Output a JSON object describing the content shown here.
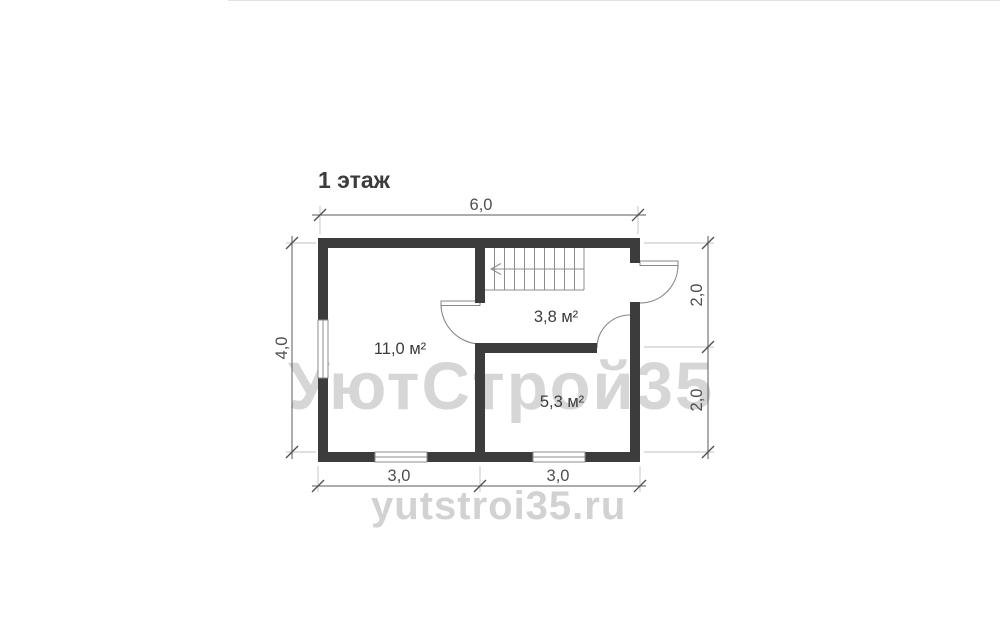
{
  "title": "1 этаж",
  "watermark": {
    "brand": "УютСтрой35",
    "site": "yutstroi35.ru"
  },
  "dimensions": {
    "top": "6,0",
    "left": "4,0",
    "right_upper": "2,0",
    "right_lower": "2,0",
    "bottom_left": "3,0",
    "bottom_right": "3,0"
  },
  "rooms": [
    {
      "id": "room-11-0",
      "area_label": "11,0 м²"
    },
    {
      "id": "room-3-8",
      "area_label": "3,8 м²"
    },
    {
      "id": "room-5-3",
      "area_label": "5,3 м²"
    }
  ],
  "colors": {
    "wall": "#3c3c3c",
    "plan_line": "#8c8c8c",
    "dimension": "#4f4f4f",
    "watermark": "#d6d6d6",
    "background": "#ffffff"
  }
}
